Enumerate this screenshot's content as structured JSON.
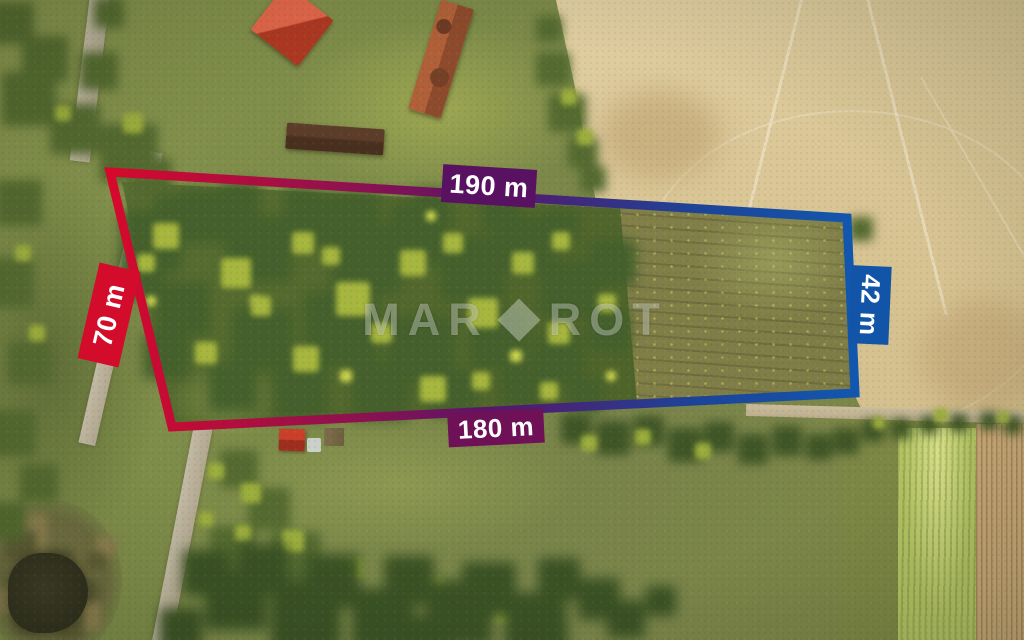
{
  "page": {
    "title": "Aerial land plot with boundary measurements"
  },
  "measurements": {
    "top": "190 m",
    "bottom": "180 m",
    "left": "70 m",
    "right": "42 m"
  },
  "watermark": {
    "part1": "MAR",
    "part2": "ROT"
  },
  "overlay_colors": {
    "red": "#d6092c",
    "red_purple": "#8d1250",
    "purple": "#5d1467",
    "blue_purple": "#1d4397",
    "blue": "#1257ae",
    "label_top_bg": "#581261",
    "label_bottom_bg": "#6e1157",
    "label_left_bg": "#d30c2b",
    "label_right_bg": "#1254a8",
    "label_text": "#ffffff",
    "watermark_color": "rgba(255,255,255,0.34)"
  },
  "photo_palette": {
    "grass_green": "#7d8a48",
    "field_tan": "#d9c59c",
    "forest_dark_green": "#45602c",
    "pond_water": "#33311f",
    "road_gray": "#b6ac96",
    "roof_red": "#cf4a2e"
  },
  "scene_description": "Drone aerial view of a rural building plot: woodland and meadow inside the outlined boundary, ploughed tan field to the north-east, lane along the west edge, farm buildings with red roofs to the north, small pond at the south-west, meadows, hedgerows and tree belts to the south."
}
